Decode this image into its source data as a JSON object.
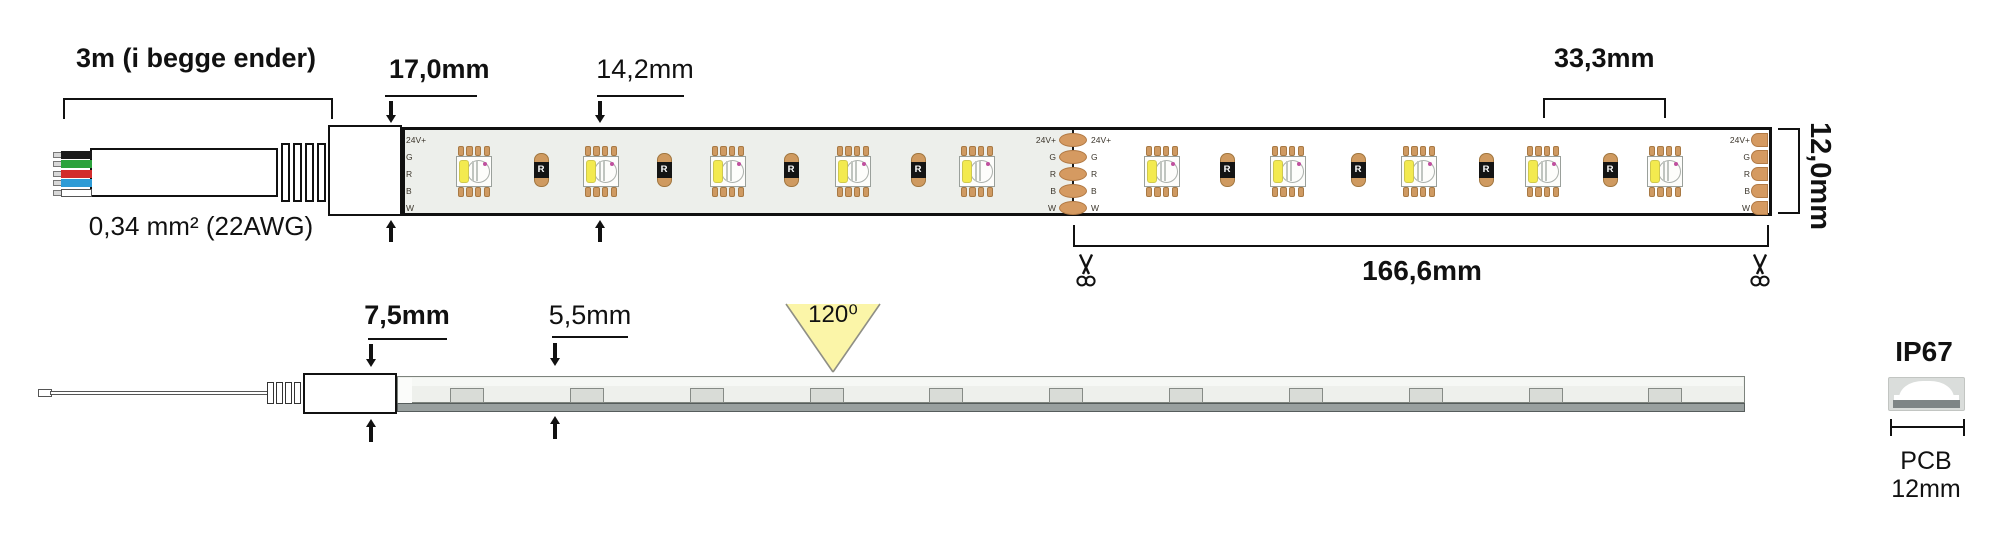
{
  "diagram": {
    "top_view": {
      "cable_length_label": "3m (i begge ender)",
      "wire_gauge_label": "0,34 mm² (22AWG)",
      "connector_width_label": "17,0mm",
      "led_width_label": "14,2mm",
      "led_pitch_label": "33,3mm",
      "strip_width_label": "12,0mm",
      "cut_length_label": "166,6mm",
      "pad_labels": [
        "24V+",
        "G",
        "R",
        "B",
        "W"
      ],
      "resistor_label": "R"
    },
    "side_view": {
      "connector_height_label": "7,5mm",
      "strip_height_label": "5,5mm",
      "beam_angle_label": "120⁰"
    },
    "ip_block": {
      "rating_label": "IP67",
      "pcb_label": "PCB",
      "pcb_width_label": "12mm"
    },
    "colors": {
      "wire_colors": [
        "#1a1a1a",
        "#2ba23c",
        "#d22c2c",
        "#2d9bd6",
        "#ffffff"
      ],
      "pad_copper": "#d59a61",
      "led_pad_copper": "#cf9a62",
      "resistor_body": "#cf9a60",
      "led_yellow": "#f3ea4f",
      "beam_yellow": "#fbf5a8",
      "strip_segment_gray": "#edefeb"
    }
  }
}
